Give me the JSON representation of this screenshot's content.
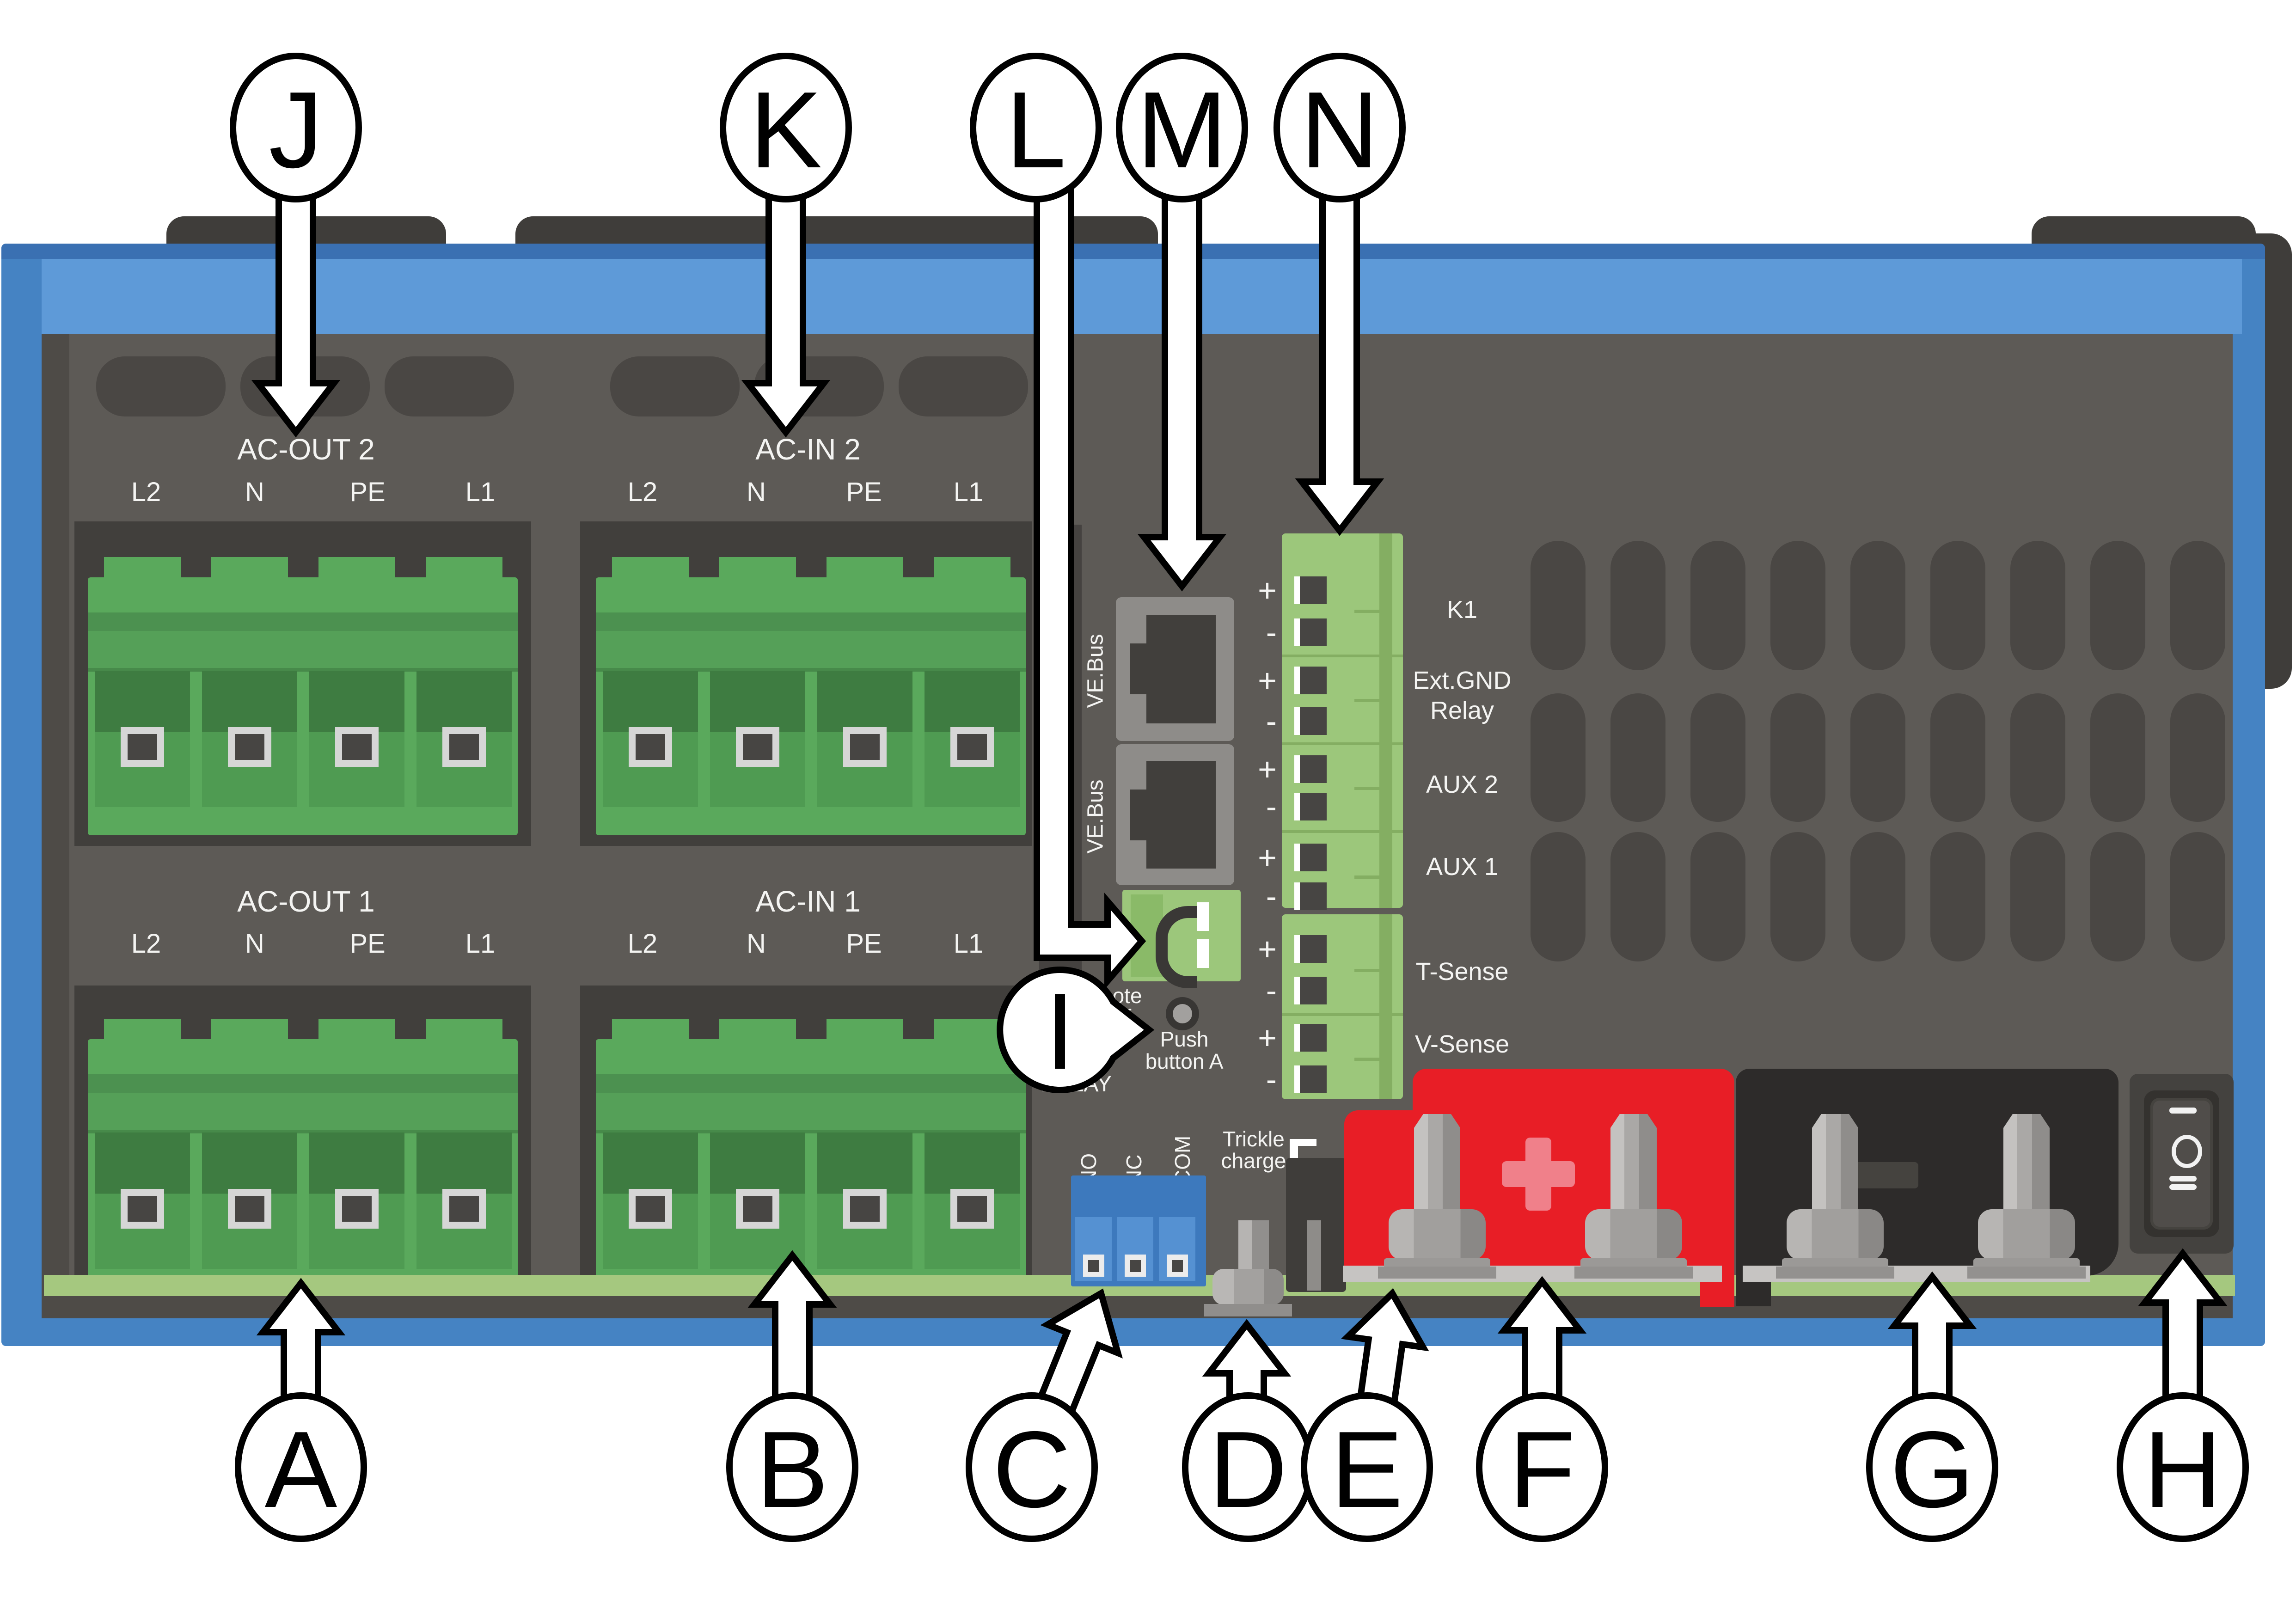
{
  "diagram_title": "Inverter/charger connection overview",
  "colors": {
    "frame_blue": "#4583c3",
    "frame_band": "#5e9ad8",
    "panel_gray": "#5d5a56",
    "recess_gray": "#413f3c",
    "terminal_green": "#5aa95c",
    "strip_green": "#9cc77b",
    "pcb_green": "#a5c87f",
    "relay_blue": "#3d79bd",
    "battery_positive_red": "#e81e26",
    "battery_negative_black": "#2d2b2a",
    "metal_gray": "#b4b2b0",
    "text_white": "#f4f4f2"
  },
  "pin_labels": [
    "L2",
    "N",
    "PE",
    "L1"
  ],
  "blocks": {
    "ac_out_2": "AC-OUT 2",
    "ac_in_2": "AC-IN 2",
    "ac_out_1": "AC-OUT 1",
    "ac_in_1": "AC-IN 1"
  },
  "ve_bus": {
    "label": "VE.Bus"
  },
  "terminal_strip": {
    "signs": [
      "+",
      "-",
      "+",
      "-",
      "+",
      "-",
      "+",
      "-",
      "+",
      "-",
      "+",
      "-"
    ],
    "channels": {
      "k1": "K1",
      "ext_gnd_line1": "Ext.GND",
      "ext_gnd_line2": "Relay",
      "aux2": "AUX 2",
      "aux1": "AUX 1",
      "t_sense": "T-Sense",
      "v_sense": "V-Sense"
    }
  },
  "remote": {
    "line1": "Remote",
    "line2": "on/off"
  },
  "push_button": {
    "line1": "Push",
    "line2": "button A"
  },
  "relay": {
    "title": "RELAY",
    "pins": [
      "NO",
      "NC",
      "COM"
    ]
  },
  "trickle": {
    "line1": "Trickle",
    "line2": "charge"
  },
  "battery": {
    "positive_symbol": "+",
    "negative_symbol": "-"
  },
  "power_switch": {
    "positions": [
      "I",
      "O",
      "II"
    ]
  },
  "callouts": {
    "a": "A",
    "b": "B",
    "c": "C",
    "d": "D",
    "e": "E",
    "f": "F",
    "g": "G",
    "h": "H",
    "i": "I",
    "j": "J",
    "k": "K",
    "l": "L",
    "m": "M",
    "n": "N"
  }
}
